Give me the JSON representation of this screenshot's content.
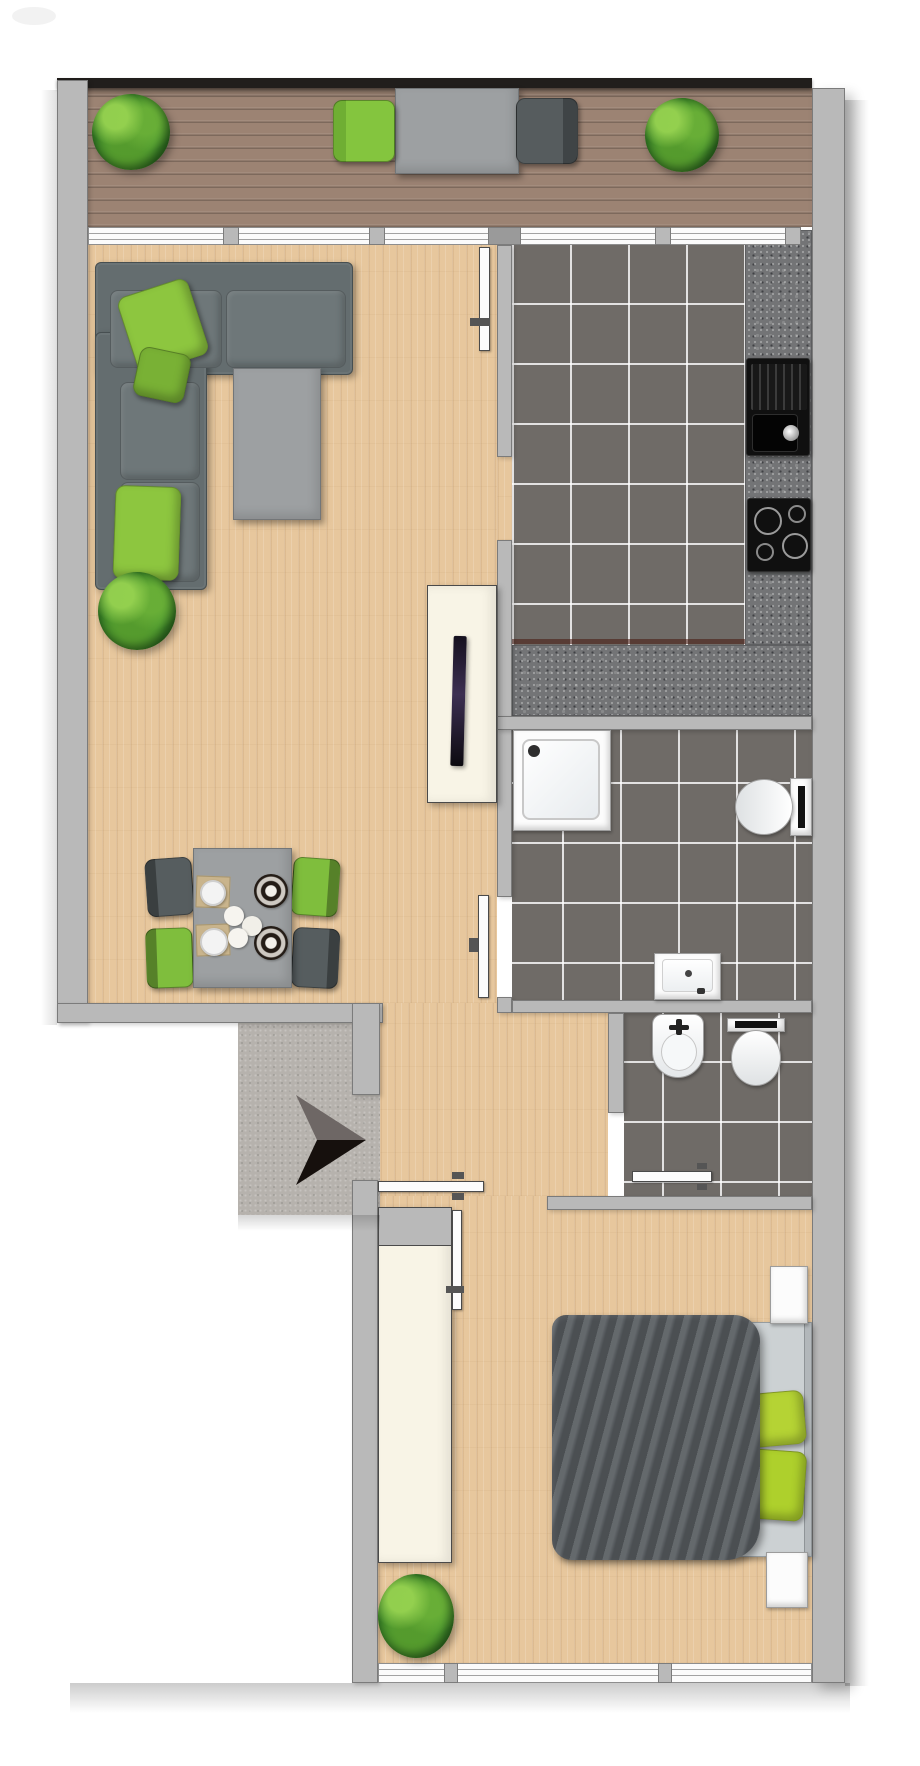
{
  "plan": {
    "type": "apartment-floor-plan",
    "style": "top-down 2D render, no text labels",
    "orientation": "entrance on left, balcony on top, bedroom at bottom"
  },
  "colors": {
    "wall": "#b9b9b9",
    "wall_border": "#7b7b7b",
    "railing": "#211e1c",
    "deck": "#9c8373",
    "wood": "#e7c79d",
    "tile": "#6f6b67",
    "granite": "#737476",
    "concrete": "#b6b2ad",
    "window": "#fbfbfb",
    "sofa": "#646d6f",
    "pillow_green": "#8dc63f",
    "bed_pillow_green": "#b5d334",
    "chair_green": "#7fbe3d",
    "chair_gray": "#565d5f",
    "furniture_gray": "#9da0a2",
    "cream": "#f8f4e6",
    "blanket": "#575c60",
    "fixture_white": "#fcfcfc",
    "appliance_black": "#101010",
    "arrow_gray": "#6e6765",
    "arrow_black": "#16100d",
    "plant_green": "#4f9c31"
  },
  "rooms": [
    {
      "name": "balcony",
      "floor": "wood-deck",
      "furniture": [
        "potted-plant",
        "green-lounge-chair",
        "outdoor-table",
        "dark-lounge-chair",
        "potted-plant"
      ]
    },
    {
      "name": "living-room",
      "floor": "parquet",
      "furniture": [
        "corner-sofa",
        "green-pillows",
        "coffee-table",
        "potted-plant",
        "dining-table",
        "two-green-chairs",
        "two-gray-chairs",
        "tv-sideboard",
        "flat-tv"
      ]
    },
    {
      "name": "kitchen",
      "floor": "dark-tile",
      "furniture": [
        "granite-counter",
        "black-sink",
        "cooktop"
      ]
    },
    {
      "name": "bathroom",
      "floor": "dark-tile",
      "furniture": [
        "shower",
        "wall-toilet",
        "washbasin"
      ]
    },
    {
      "name": "wc",
      "floor": "dark-tile",
      "furniture": [
        "bidet",
        "toilet"
      ]
    },
    {
      "name": "entrance",
      "floor": "concrete",
      "furniture": [
        "entry-direction-arrow",
        "entry-door"
      ]
    },
    {
      "name": "hallway",
      "floor": "parquet",
      "furniture": []
    },
    {
      "name": "bedroom",
      "floor": "parquet",
      "furniture": [
        "wardrobe",
        "double-bed",
        "gray-blanket",
        "green-pillows",
        "nightstand",
        "nightstand",
        "potted-plant"
      ]
    }
  ]
}
